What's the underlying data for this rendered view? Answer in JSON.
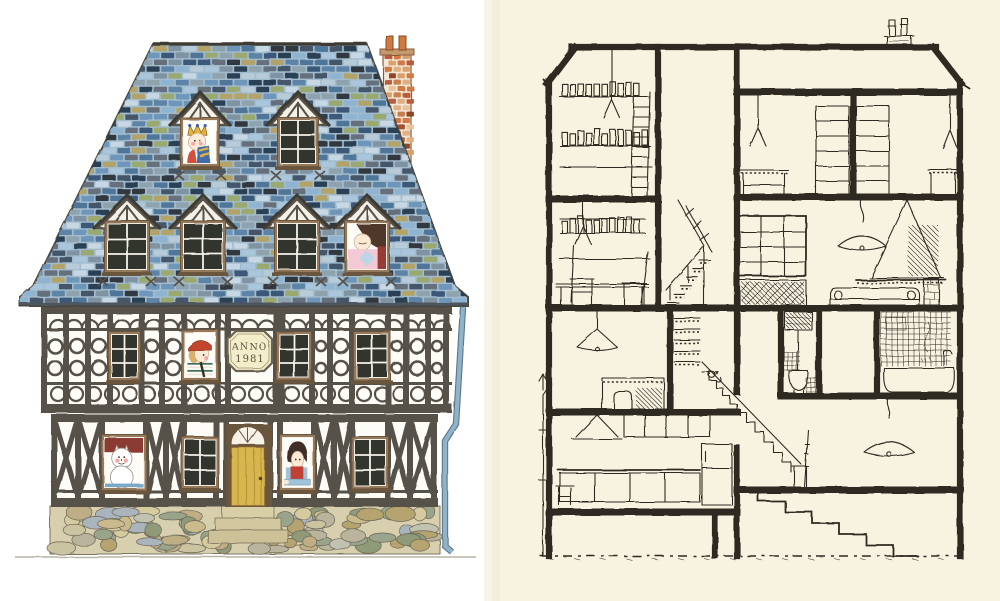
{
  "artwork": {
    "kind": "picture-book spread: house front elevation (left) and ink cross-section of the same house (right)",
    "left_page": {
      "background": "#ffffff",
      "ground_line": "#b9b4a6"
    },
    "right_page": {
      "background": "#f8f3e1",
      "ink": "#2e2a24"
    },
    "sign": {
      "line1": "ANNO",
      "line2": "1981"
    },
    "palettes": {
      "roof_base": "#a3bccd",
      "roof_slate": [
        "#8fb4d2",
        "#6d96ba",
        "#4f7499",
        "#3a5878",
        "#2c3f54",
        "#a9c6dd",
        "#5d83a6",
        "#7f93a3",
        "#45566b",
        "#8ea3ae",
        "#b7cbd9",
        "#66707b",
        "#9aa96f",
        "#b2a468",
        "#32373f",
        "#c7d7e3"
      ],
      "chimney_mortar": "#f2e6d6",
      "chimney_brick": [
        "#c97f4e",
        "#b85c3a",
        "#d9a06a",
        "#e8c39a",
        "#a34f2c",
        "#d27a45",
        "#e0b084",
        "#8f4428"
      ],
      "stone_bed": "#d8cfae",
      "stone": [
        "#cbbb8c",
        "#b5a36f",
        "#9aa48a",
        "#c2c2b0",
        "#a9b4bd",
        "#d6ca9f",
        "#8f9a78",
        "#bfae85",
        "#ccc3a0",
        "#b9b49b"
      ],
      "timber": "#56514a",
      "plaster": "#fdfcf7",
      "window_pane": "#33352e",
      "window_frame": "#96795a",
      "frame_dark": "#6b543c",
      "door": "#d7b64e",
      "door_line": "#b2943c",
      "downspout": "#8fb3c9",
      "sign_bg": "#f3edc9",
      "sign_text": "#5c5142",
      "skin": "#fbebd6"
    },
    "figure_colors": {
      "king_crown": "#e8b33a",
      "king_crown_blue": "#3f5fa8",
      "king_robe_left": "#d0503e",
      "king_robe_right": "#3f6cae",
      "queen_hair": "#4f372c",
      "queen_dress": "#f2c9d4",
      "queen_accent": "#993a35",
      "queen_diamond": "#bcd6e8",
      "watchman_cap": "#c2452f",
      "watchman_hair": "#d9b36a",
      "watchman_shirt": "#3f6f5f",
      "watchman_shirt_light": "#ece7d8",
      "cat_backdrop": "#8c3b33",
      "cat_fur": "#ffffff",
      "cat_cheek": "#f0a8a8",
      "cat_sill": "#7aa8c8",
      "boy_hair": "#3f2e26",
      "boy_vest": "#bf4135",
      "boy_shirt": "#9fc3d8"
    },
    "figures": [
      {
        "name": "king",
        "location": "top dormer, left"
      },
      {
        "name": "queen",
        "location": "second-row dormer, right"
      },
      {
        "name": "watchman-with-red-cap",
        "location": "first-floor window"
      },
      {
        "name": "white-cat",
        "location": "ground-floor window, left"
      },
      {
        "name": "boy-in-red-vest",
        "location": "ground-floor window, right of door"
      }
    ],
    "cross_section_rooms": [
      "attic with book shelves and ladder",
      "attic landing with stair banister",
      "attic storage with cupboards and hanging lamps",
      "study with desk, chairs and wall shelves",
      "living room with paned partition and balustrade",
      "kitchen-living with extractor hood, hanging lamp and sofa",
      "room with masonry stove and hanging lamp",
      "ground-floor kitchen with hood, cupboards, counter, refrigerator and stool",
      "stair hall with long staircase and chair",
      "toilet with high cistern",
      "bathroom with tiled wall and bathtub",
      "room with pendant lamp",
      "cellar steps under the house"
    ]
  }
}
